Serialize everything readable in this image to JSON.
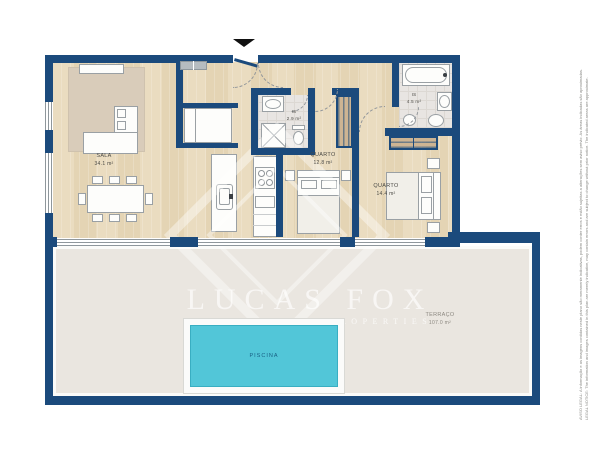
{
  "brand": {
    "name": "LUCAS FOX",
    "tagline": "INTERNATIONAL PROPERTIES"
  },
  "plan": {
    "rooms": [
      {
        "name": "SALA",
        "area": "34.1 m²"
      },
      {
        "name": "IS",
        "area": "2.9 m²"
      },
      {
        "name": "QUARTO",
        "area": "12.8 m²"
      },
      {
        "name": "QUARTO",
        "area": "14.4 m²"
      },
      {
        "name": "IS",
        "area": "4.5 m²"
      },
      {
        "name": "TERRAÇO",
        "area": "107.0 m²"
      },
      {
        "name": "PISCINA",
        "area": ""
      }
    ]
  },
  "legal": {
    "aviso": "AVISO LEGAL: A informação e as imagens contidas neste plano são meramente indicativas, podem conter erros e estão sujeitas a alterações sem aviso prévio. As áreas indicadas são aproximadas.",
    "notice": "LEGAL NOTICE: The information and images contained in this plan are merely indicative, may contain errors and are subject to change without prior notice. The indicated areas are approximate."
  },
  "colors": {
    "wall": "#1b4a7c",
    "wood": "#e8dabd",
    "bath": "#e8e5e2",
    "terrace": "#eae6e0",
    "pool": "#52c6d8",
    "rug": "#d9ccba"
  }
}
